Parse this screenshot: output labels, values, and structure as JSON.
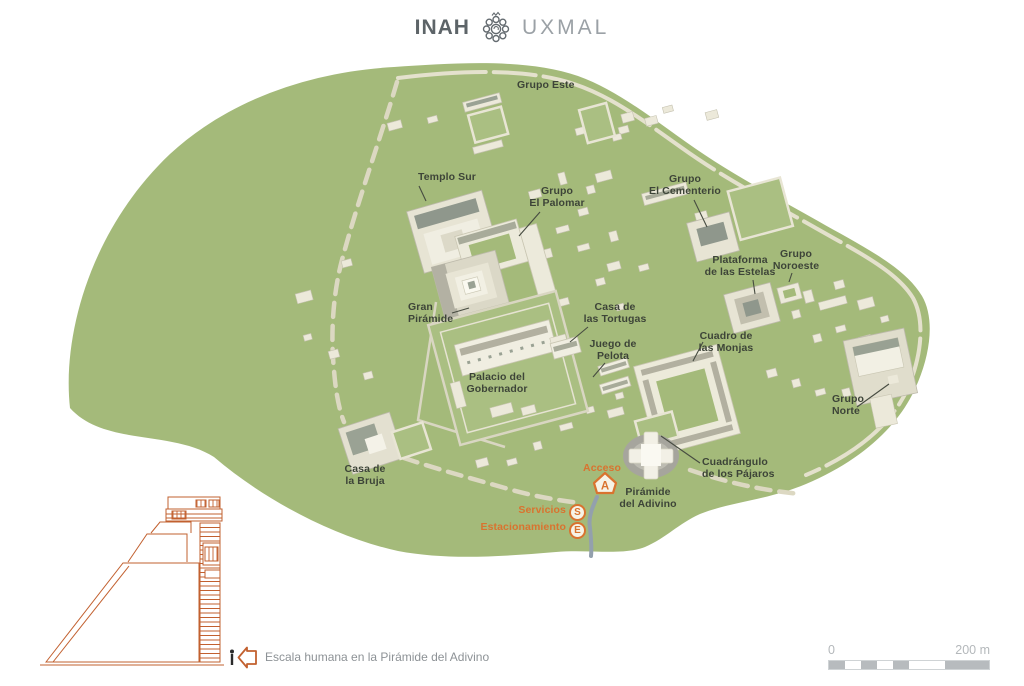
{
  "header": {
    "brand": "INAH",
    "site": "UXMAL",
    "logo_icon": "inah-rosette-icon"
  },
  "map": {
    "background_color": "#a4ba7a",
    "structure_color": "#ece9da",
    "label_color": "#3d4438",
    "accent_color": "#d9732f",
    "labels": [
      {
        "id": "grupo-este",
        "text": "Grupo Este"
      },
      {
        "id": "templo-sur",
        "text": "Templo Sur"
      },
      {
        "id": "grupo-el-palomar",
        "text": "Grupo\nEl Palomar"
      },
      {
        "id": "grupo-el-cementerio",
        "text": "Grupo\nEl Cementerio"
      },
      {
        "id": "plataforma-de-las-estelas",
        "text": "Plataforma\nde las Estelas"
      },
      {
        "id": "grupo-noroeste",
        "text": "Grupo\nNoroeste"
      },
      {
        "id": "gran-piramide",
        "text": "Gran\nPirámide"
      },
      {
        "id": "casa-de-las-tortugas",
        "text": "Casa de\nlas Tortugas"
      },
      {
        "id": "juego-de-pelota",
        "text": "Juego de\nPelota"
      },
      {
        "id": "palacio-del-gobernador",
        "text": "Palacio del\nGobernador"
      },
      {
        "id": "cuadro-de-las-monjas",
        "text": "Cuadro de\nlas Monjas"
      },
      {
        "id": "grupo-norte",
        "text": "Grupo\nNorte"
      },
      {
        "id": "casa-de-la-bruja",
        "text": "Casa de\nla Bruja"
      },
      {
        "id": "cuadrangulo-de-los-pajaros",
        "text": "Cuadrángulo\nde los Pájaros"
      },
      {
        "id": "piramide-del-adivino",
        "text": "Pirámide\ndel Adivino"
      },
      {
        "id": "acceso",
        "text": "Acceso"
      },
      {
        "id": "servicios",
        "text": "Servicios"
      },
      {
        "id": "estacionamiento",
        "text": "Estacionamiento"
      }
    ],
    "badges": {
      "access": "A",
      "services": "S",
      "parking": "E"
    }
  },
  "legend": {
    "human_scale_caption": "Escala humana en la Pirámide del Adivino"
  },
  "scale_bar": {
    "start": "0",
    "end": "200 m"
  }
}
